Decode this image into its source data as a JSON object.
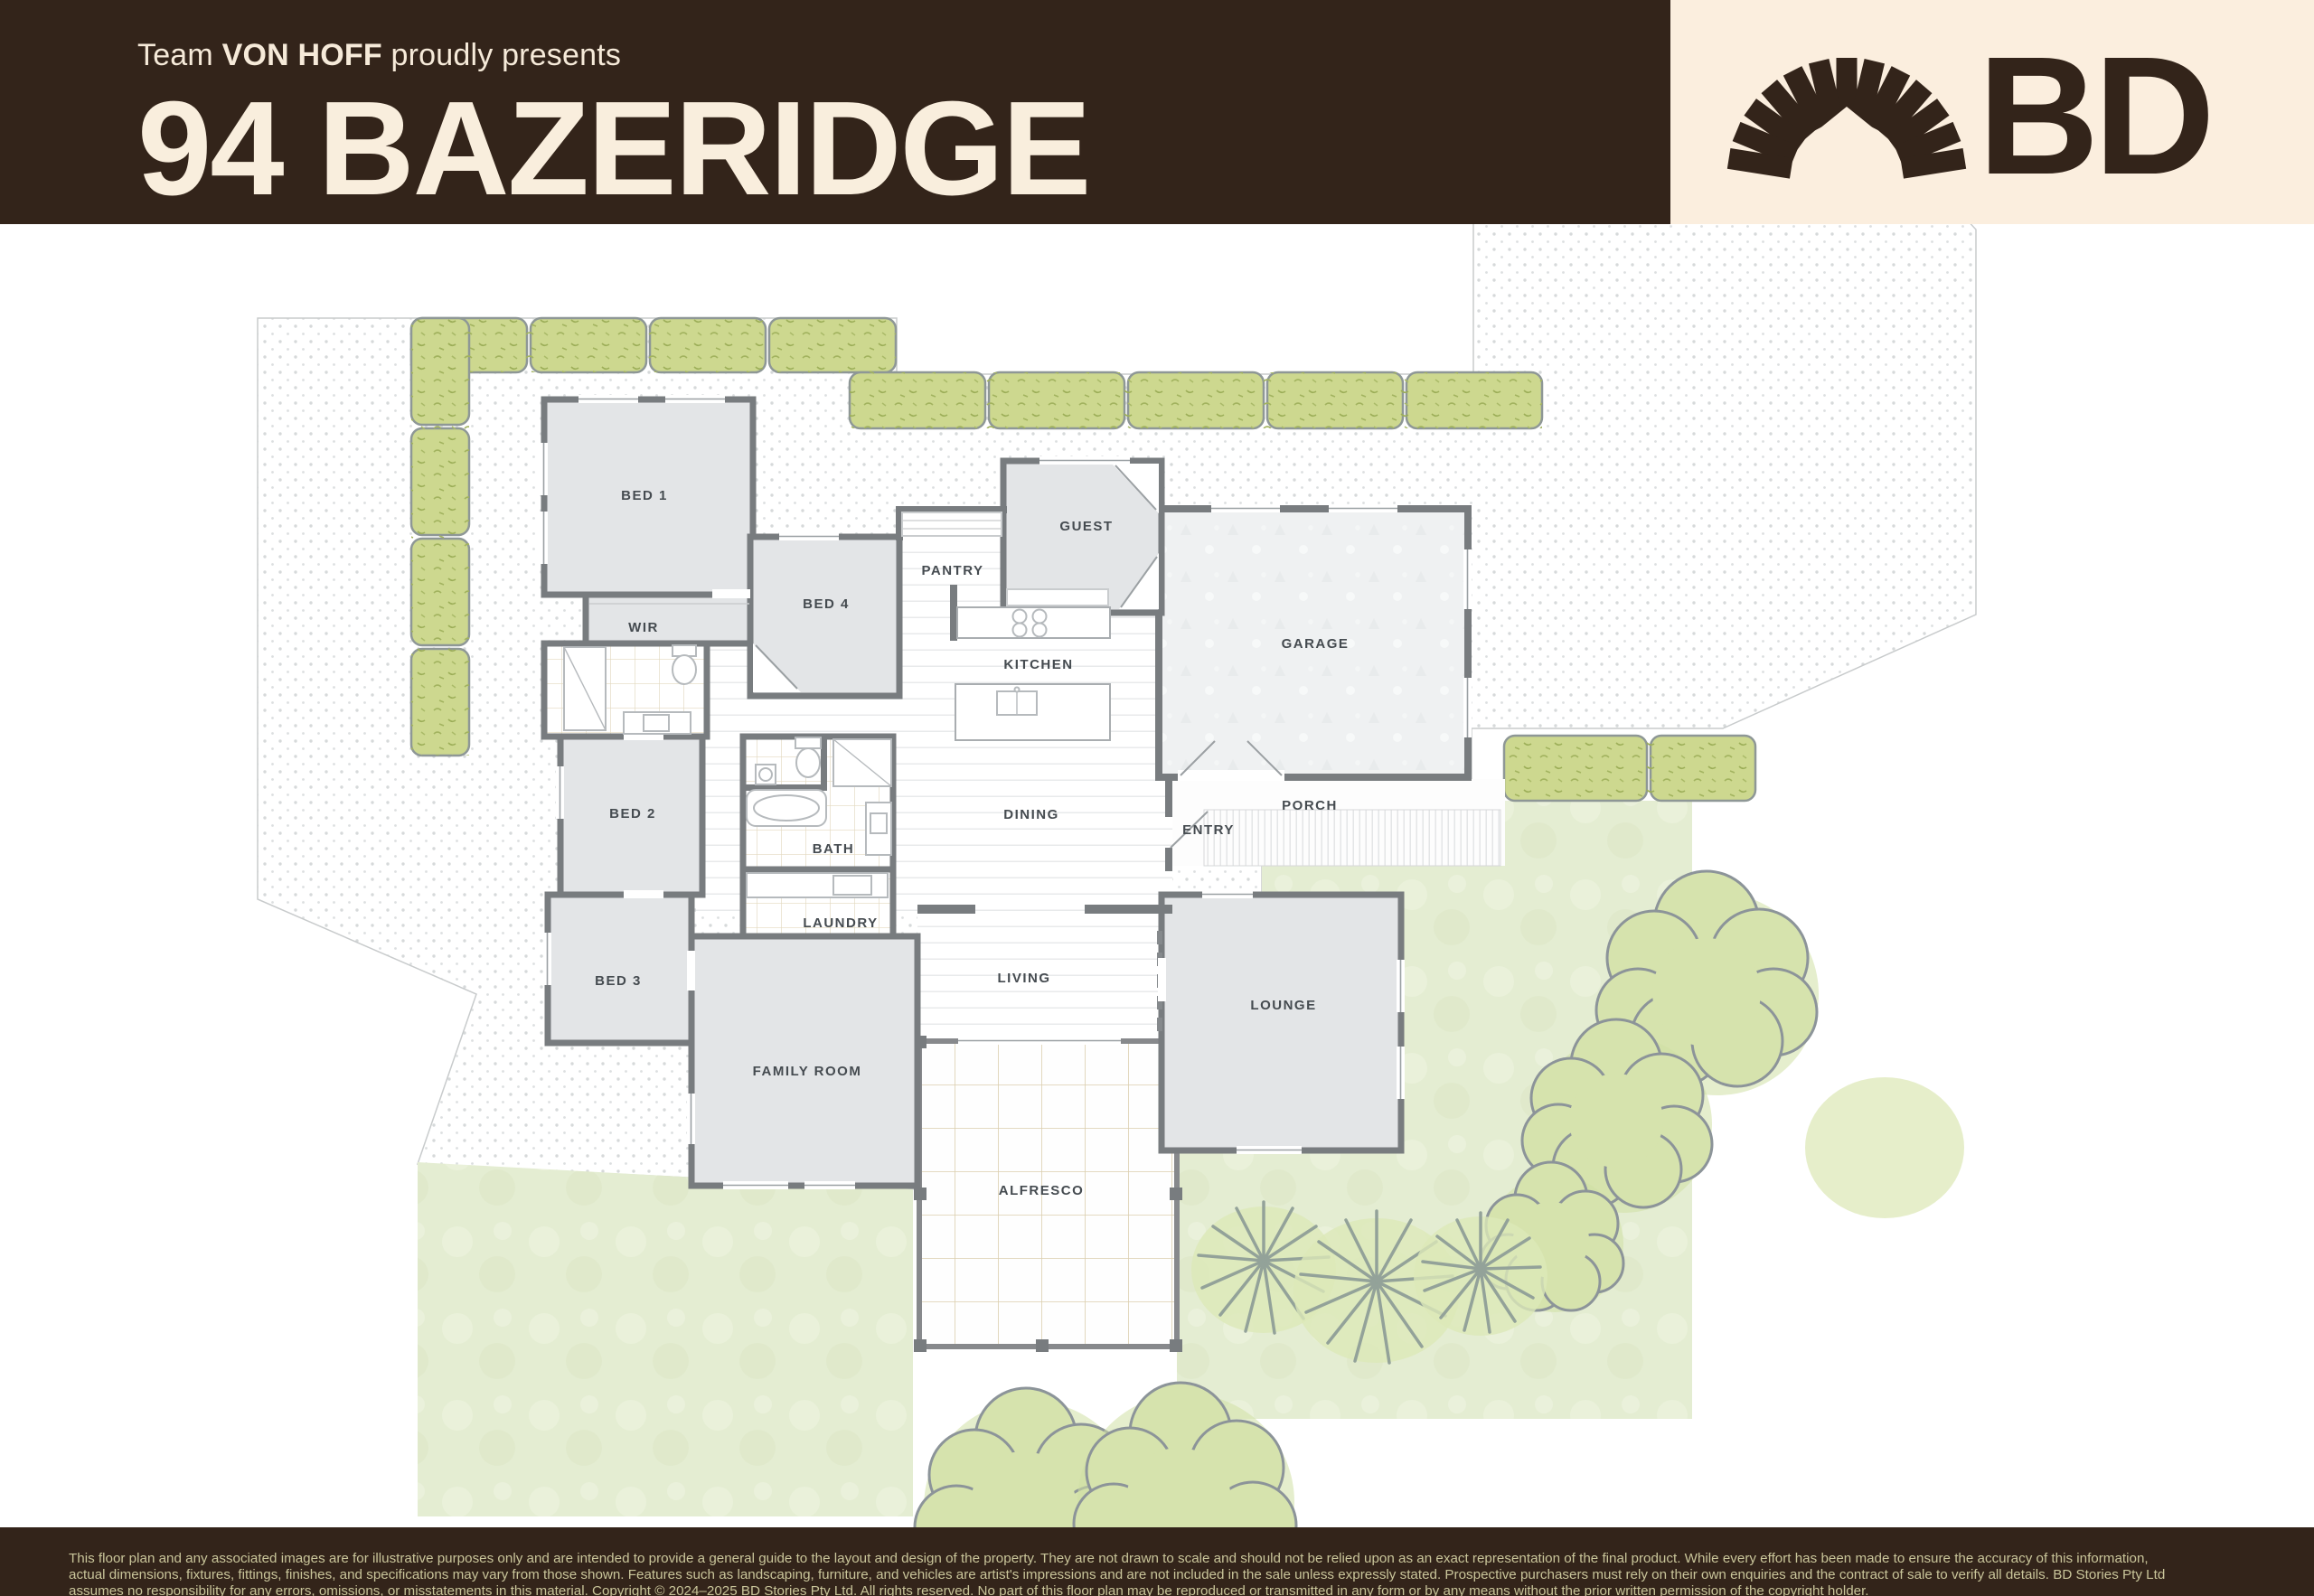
{
  "header": {
    "team_prefix": "Team ",
    "team_name": "VON HOFF",
    "presents_suffix": " proudly presents",
    "title": "94 BAZERIDGE"
  },
  "logo": {
    "brand": "BD",
    "icon": "sunburst-arch-house-icon"
  },
  "floorplan": {
    "rooms": [
      {
        "label": "BED 1"
      },
      {
        "label": "WIR"
      },
      {
        "label": "BED 4"
      },
      {
        "label": "PANTRY"
      },
      {
        "label": "GUEST"
      },
      {
        "label": "GARAGE"
      },
      {
        "label": "KITCHEN"
      },
      {
        "label": "DINING"
      },
      {
        "label": "ENTRY"
      },
      {
        "label": "PORCH"
      },
      {
        "label": "BED 2"
      },
      {
        "label": "BATH"
      },
      {
        "label": "LAUNDRY"
      },
      {
        "label": "BED 3"
      },
      {
        "label": "FAMILY ROOM"
      },
      {
        "label": "LIVING"
      },
      {
        "label": "LOUNGE"
      },
      {
        "label": "ALFRESCO"
      }
    ]
  },
  "footer": {
    "disclaimer_lines": [
      "This floor plan and any associated images are for illustrative purposes only and are intended to provide a general guide to the layout and design of the property. They are not drawn to scale and should not be relied upon as an exact representation of the final product. While every effort has been made to ensure the accuracy of this information,",
      "actual dimensions, fixtures, fittings, finishes, and specifications may vary from those shown. Features such as landscaping, furniture, and vehicles are artist's impressions and are not included in the sale unless expressly stated. Prospective purchasers must rely on their own enquiries and the contract of sale to verify all details. BD Stories Pty Ltd",
      "assumes no responsibility for any errors, omissions, or misstatements in this material. Copyright © 2024–2025 BD Stories Pty Ltd. All rights reserved. No part of this floor plan may be reproduced or transmitted in any form or by any means without the prior written permission of the copyright holder."
    ]
  },
  "colors": {
    "header_brown": "#33241a",
    "cream": "#fbeede",
    "title_cream": "#f9eedd",
    "room_fill": "#e3e5e7",
    "wall": "#787c7f",
    "hedge_green": "#cdd88f",
    "grass_green": "#e4edd2",
    "footer_text": "#c9c59a"
  }
}
